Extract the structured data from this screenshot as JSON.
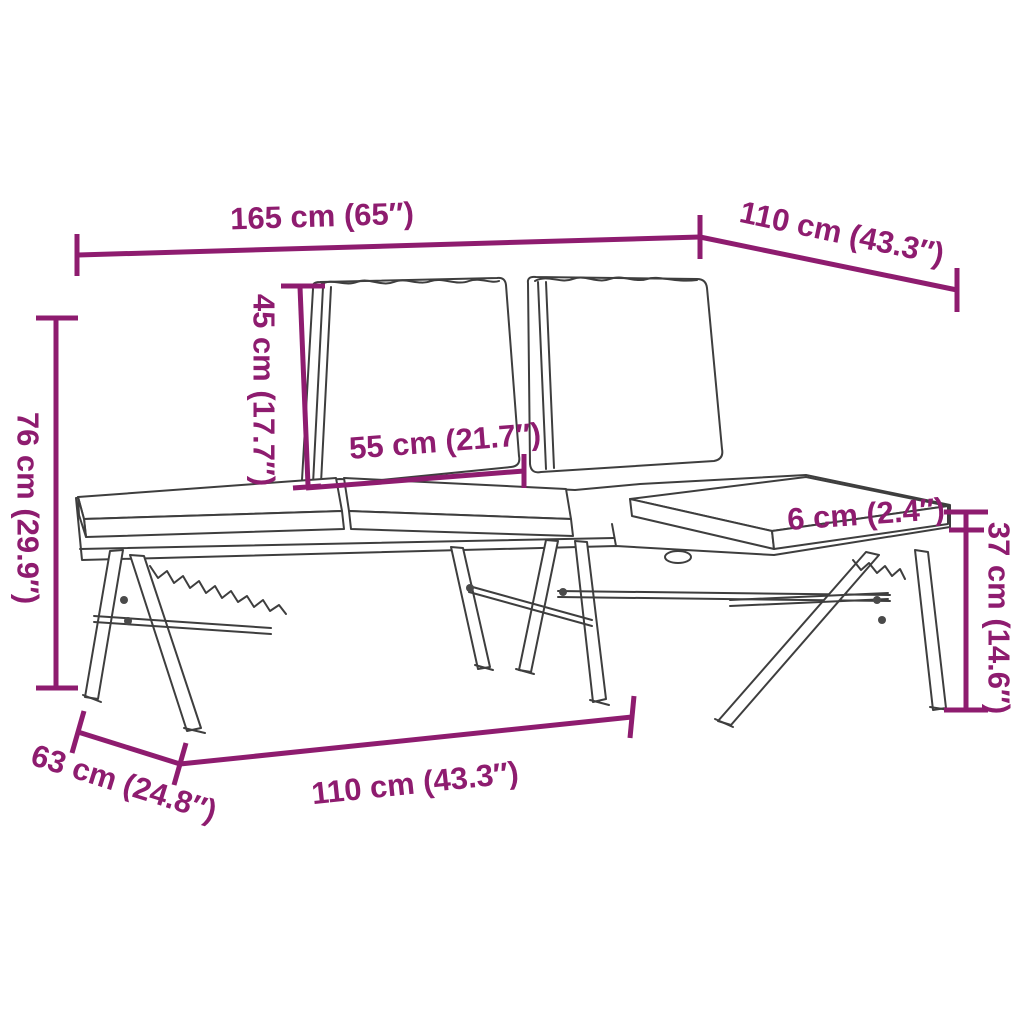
{
  "colors": {
    "accent": "#8e1c6f",
    "line_art": "#3e3e3e",
    "background": "#ffffff"
  },
  "diagram": {
    "subject": "folding-corner-bench-with-cushions",
    "dims": {
      "total_length": "165 cm (65″)",
      "right_section_depth": "110 cm (43.3″)",
      "total_height": "76 cm (29.9″)",
      "backrest_height": "45 cm (17.7″)",
      "back_cushion_width": "55 cm (21.7″)",
      "cushion_thickness": "6 cm (2.4″)",
      "seat_height": "37 cm (14.6″)",
      "bench_depth": "63 cm (24.8″)",
      "front_length": "110 cm (43.3″)"
    }
  }
}
